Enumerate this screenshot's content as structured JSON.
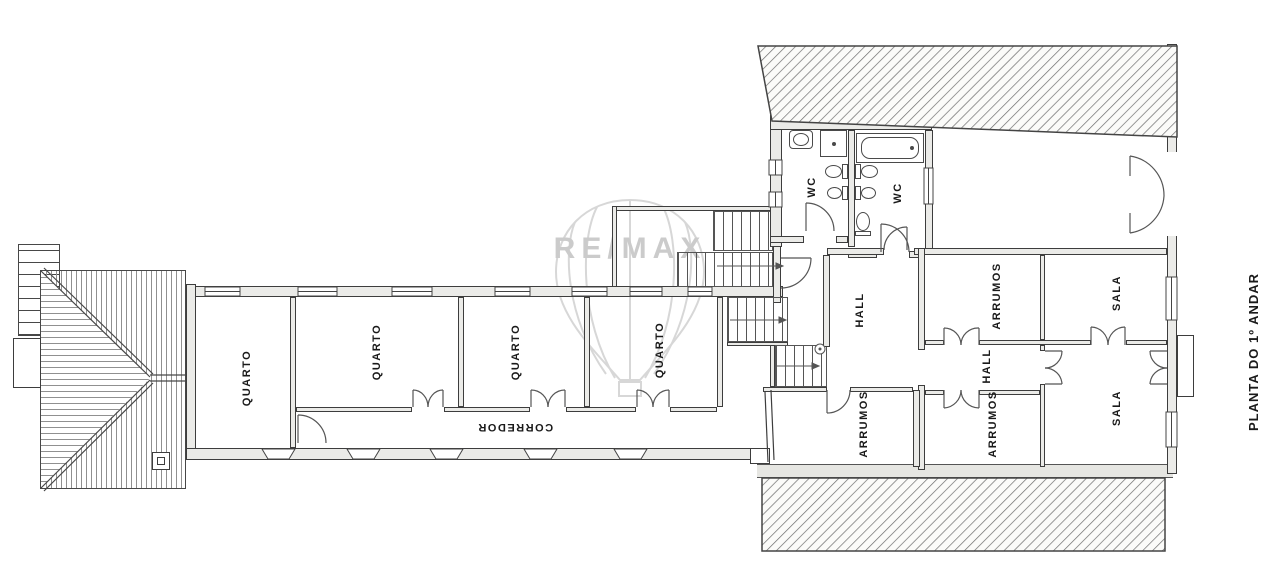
{
  "drawing": {
    "title": "PLANTA DO 1º ANDAR",
    "watermark_brand": "RE/MAX",
    "rooms": {
      "quarto_1": "QUARTO",
      "quarto_2": "QUARTO",
      "quarto_3": "QUARTO",
      "quarto_4": "QUARTO",
      "corredor": "CORREDOR",
      "hall_main": "HALL",
      "hall_small": "HALL",
      "wc_left": "WC",
      "wc_right": "WC",
      "arrumos_left": "ARRUMOS",
      "arrumos_top": "ARRUMOS",
      "arrumos_bottom": "ARRUMOS",
      "sala_top": "SALA",
      "sala_bottom": "SALA"
    },
    "colors": {
      "line": "#3d3d3d",
      "wall_fill": "#ebebe8",
      "hatch": "#6e6e6e",
      "watermark": "#cfcfcf"
    }
  }
}
